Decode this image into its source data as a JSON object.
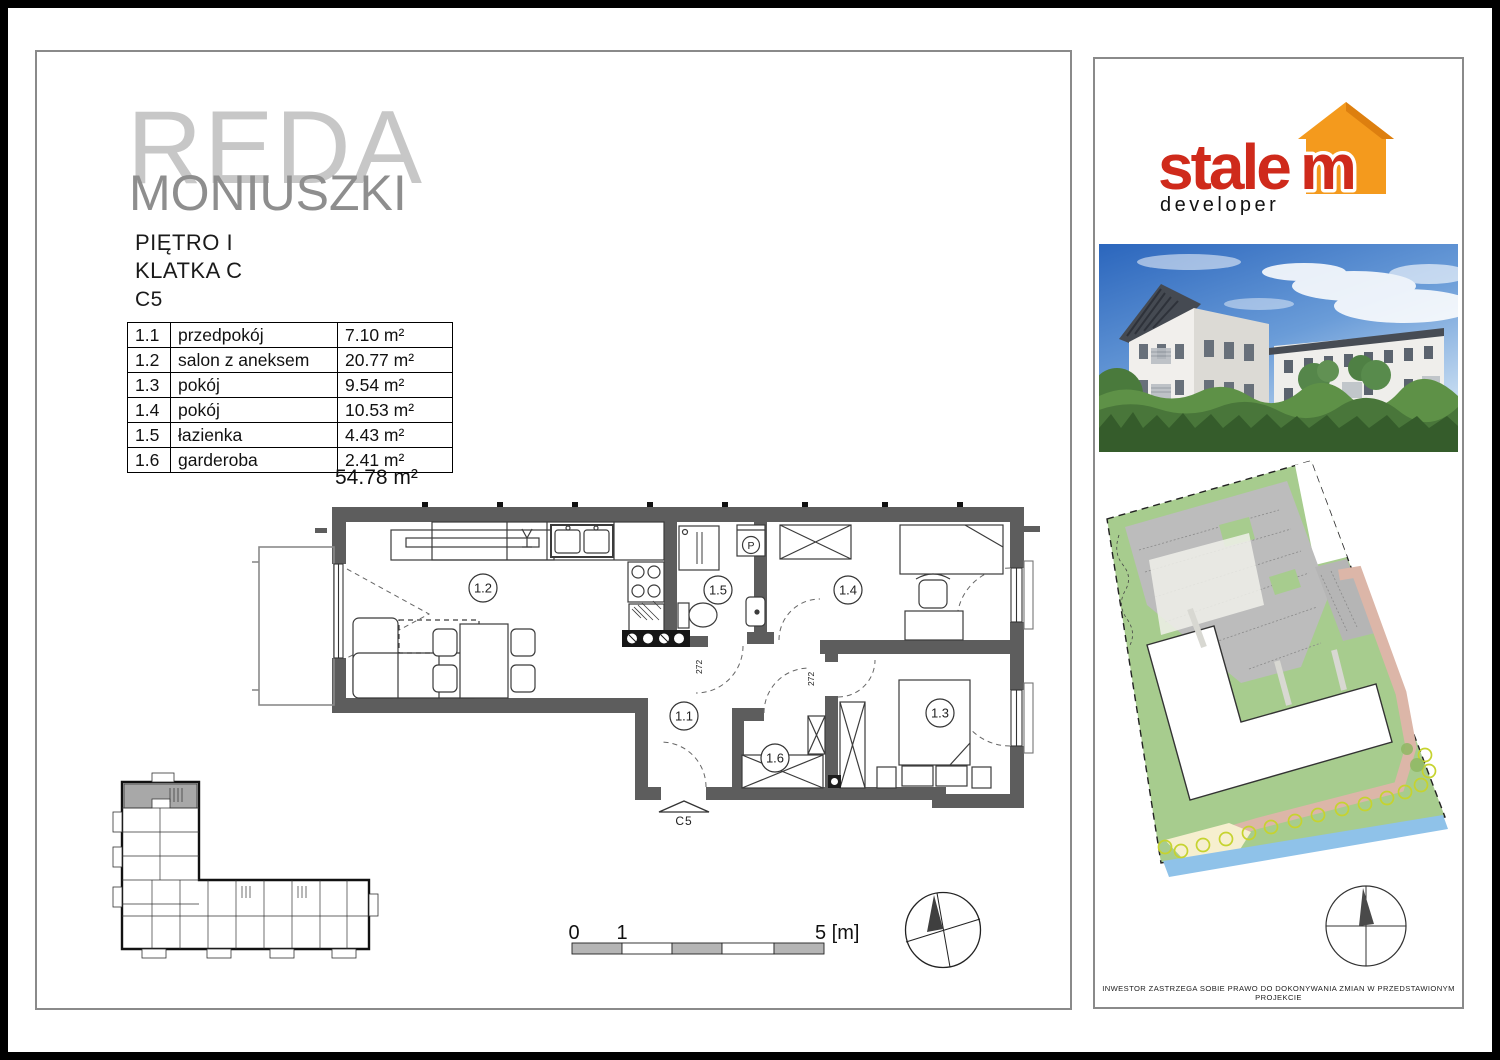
{
  "header": {
    "project": "REDA",
    "street": "MONIUSZKI",
    "floor": "PIĘTRO I",
    "staircase": "KLATKA C",
    "unit": "C5"
  },
  "rooms": {
    "rows": [
      {
        "no": "1.1",
        "name": "przedpokój",
        "area": "7.10 m²"
      },
      {
        "no": "1.2",
        "name": "salon z aneksem",
        "area": "20.77 m²"
      },
      {
        "no": "1.3",
        "name": "pokój",
        "area": "9.54 m²"
      },
      {
        "no": "1.4",
        "name": "pokój",
        "area": "10.53 m²"
      },
      {
        "no": "1.5",
        "name": "łazienka",
        "area": "4.43 m²"
      },
      {
        "no": "1.6",
        "name": "garderoba",
        "area": "2.41 m²"
      }
    ],
    "total": "54.78 m²"
  },
  "floor_plan": {
    "labels": {
      "r11": "1.1",
      "r12": "1.2",
      "r13": "1.3",
      "r14": "1.4",
      "r15": "1.5",
      "r16": "1.6"
    },
    "entrance": "C5",
    "washer": "P",
    "door_width_1": "272",
    "door_width_2": "272"
  },
  "scale_bar": {
    "zero": "0",
    "one": "1",
    "five": "5 [m]"
  },
  "brand": {
    "word_main": "stale",
    "word_m": "m",
    "subtitle": "developer"
  },
  "colors": {
    "brand_red": "#cf2a1b",
    "brand_orange": "#f49a1d",
    "wall_gray": "#5d5d5d",
    "site_green": "#a7cc8e",
    "site_water": "#8fc2e9",
    "site_path": "#dcb6a8",
    "highlight_gray": "#a8a8a8"
  },
  "disclaimer": "INWESTOR ZASTRZEGA SOBIE PRAWO DO DOKONYWANIA ZMIAN W PRZEDSTAWIONYM PROJEKCIE"
}
